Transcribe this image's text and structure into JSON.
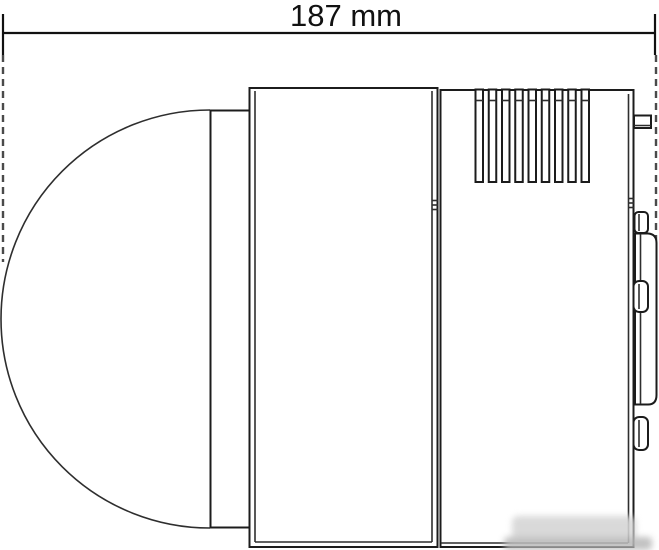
{
  "dimension": {
    "label": "187 mm",
    "value": 187,
    "unit": "mm"
  },
  "drawing": {
    "subject": "dome-camera-side-view-technical-drawing",
    "line_color": "#1c1c1c",
    "background_color": "#ffffff",
    "vent_slot_count": 9,
    "watermark": {
      "blob_color": "#d4d4d4",
      "band_color": "#b9b9b9"
    }
  }
}
